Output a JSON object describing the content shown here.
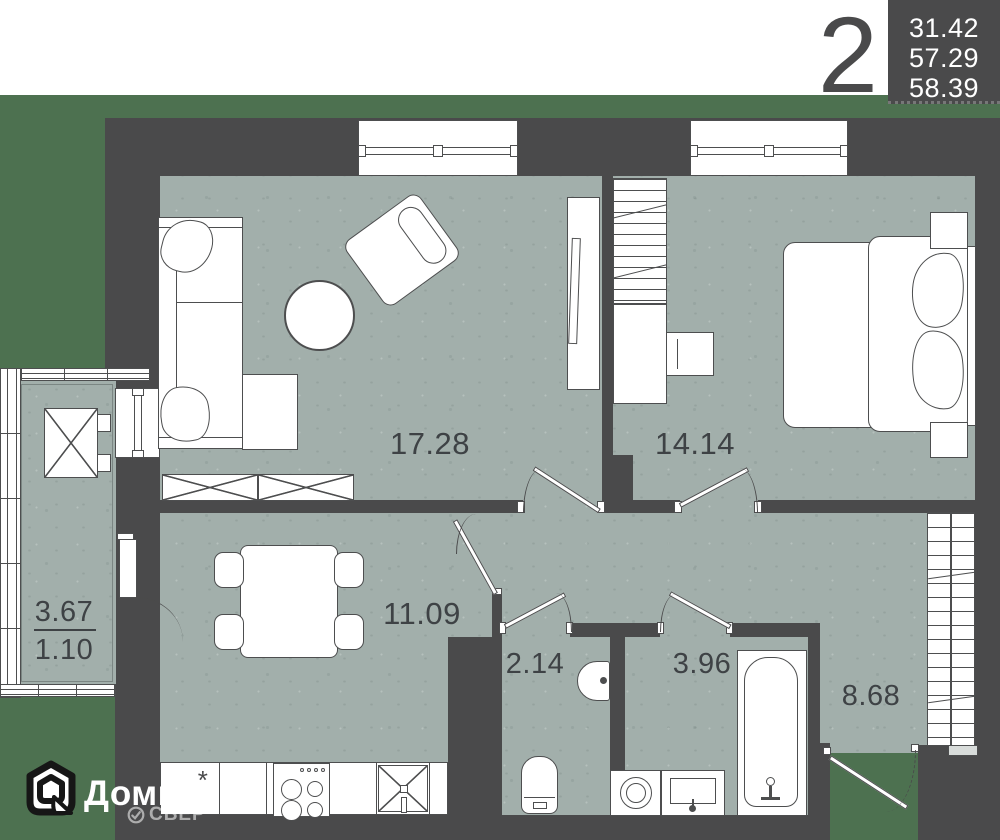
{
  "badge": {
    "rooms_count": "2",
    "areas": [
      "31.42",
      "57.29",
      "58.39"
    ]
  },
  "rooms": {
    "living": {
      "area": "17.28"
    },
    "bedroom": {
      "area": "14.14"
    },
    "hall": {
      "area": "11.09"
    },
    "wc": {
      "area": "2.14"
    },
    "bathroom": {
      "area": "3.96"
    },
    "corridor": {
      "area": "8.68"
    },
    "balcony": {
      "area": "3.67",
      "reduced_area": "1.10"
    }
  },
  "kitchen": {
    "star_symbol": "*"
  },
  "logo": {
    "brand": "Домклик",
    "subbrand": "СБЕР"
  },
  "colors": {
    "wall": "#4a4a4b",
    "floor": "#a2afab",
    "outside_green": "#4d7150",
    "label_text": "#3e4245",
    "fixture_white": "#ffffff",
    "info_box_bg": "#4a4a4b",
    "info_box_text": "#ffffff"
  }
}
